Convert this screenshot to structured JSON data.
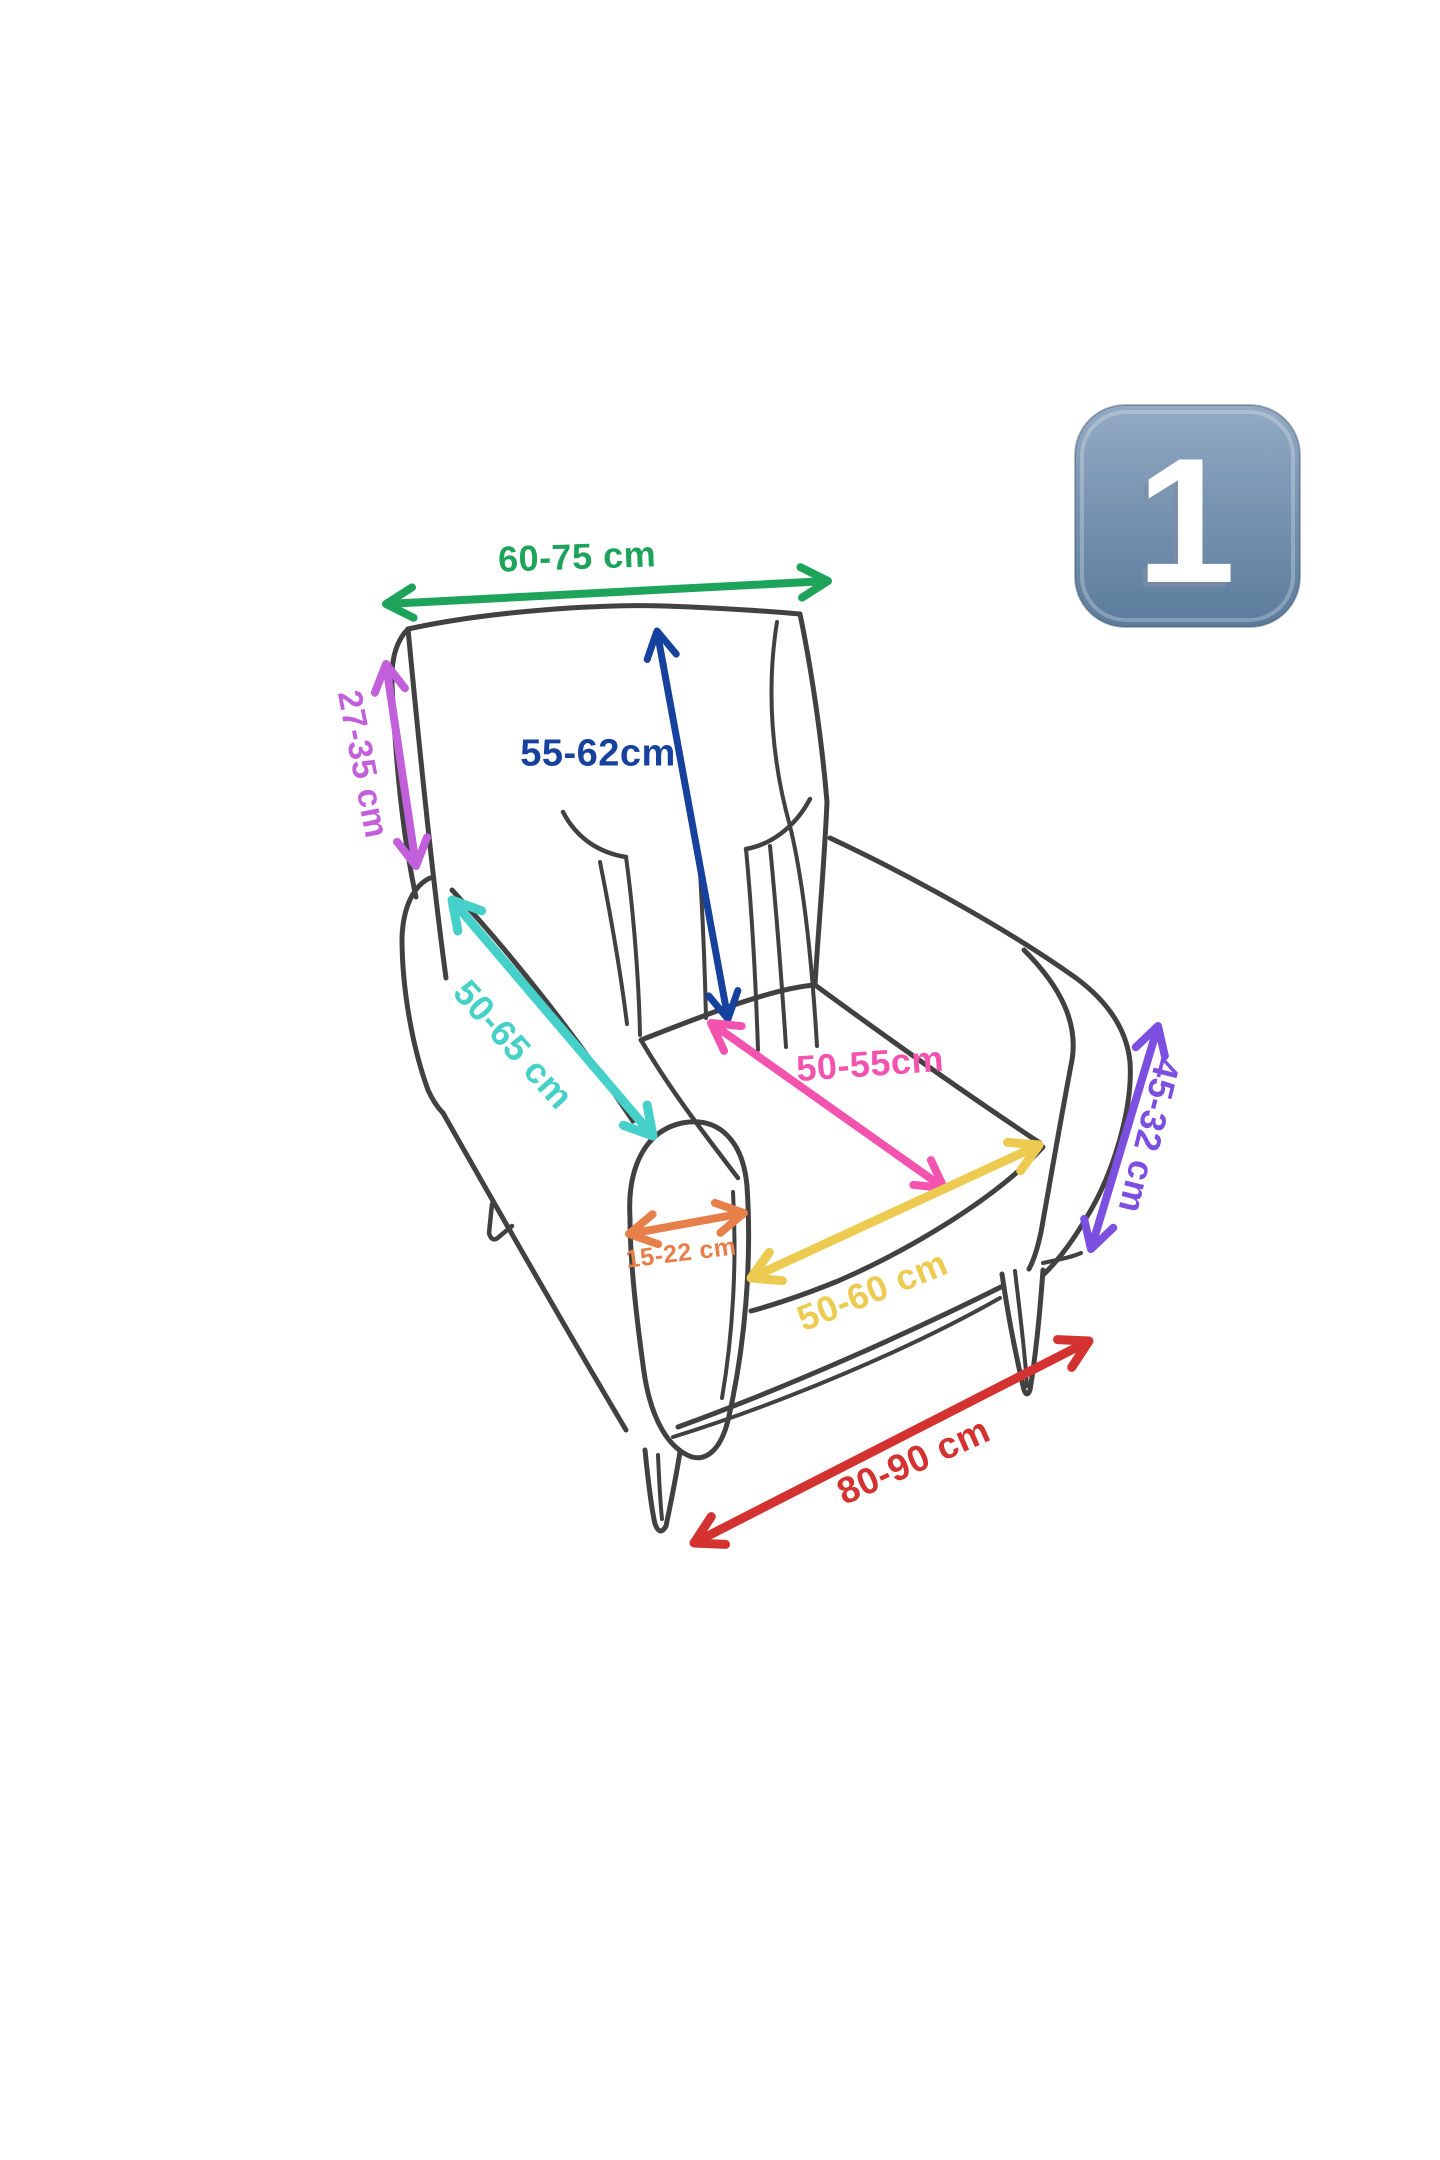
{
  "badge": {
    "label": "1",
    "bg_top": "#93aac3",
    "bg_mid": "#7592b0",
    "bg_bottom": "#5c7c9d",
    "text_color": "#ffffff",
    "shadow_color": "#7d8fa6"
  },
  "sketch": {
    "stroke_color": "#2d2d2d"
  },
  "dimensions": [
    {
      "id": "back-width",
      "label": "60-75 cm",
      "color": "#1ea35b",
      "x1": 386,
      "y1": 604,
      "x2": 828,
      "y2": 581,
      "lx": 577,
      "ly": 556,
      "rot": -2,
      "fs": 36,
      "w": 8
    },
    {
      "id": "back-side-depth",
      "label": "27-35 cm",
      "color": "#c25fda",
      "x1": 386,
      "y1": 664,
      "x2": 416,
      "y2": 866,
      "lx": 364,
      "ly": 764,
      "rot": 79,
      "fs": 34,
      "w": 8
    },
    {
      "id": "back-height",
      "label": "55-62cm",
      "color": "#16429e",
      "x1": 657,
      "y1": 631,
      "x2": 728,
      "y2": 1019,
      "lx": 598,
      "ly": 752,
      "rot": 0,
      "fs": 38,
      "w": 7
    },
    {
      "id": "armrest-length",
      "label": "50-65 cm",
      "color": "#45d0c9",
      "x1": 452,
      "y1": 900,
      "x2": 653,
      "y2": 1136,
      "lx": 514,
      "ly": 1044,
      "rot": 48,
      "fs": 36,
      "w": 9
    },
    {
      "id": "seat-depth",
      "label": "50-55cm",
      "color": "#f153af",
      "x1": 711,
      "y1": 1023,
      "x2": 944,
      "y2": 1188,
      "lx": 870,
      "ly": 1063,
      "rot": -4,
      "fs": 36,
      "w": 8
    },
    {
      "id": "armrest-width",
      "label": "15-22 cm",
      "color": "#e67f49",
      "x1": 629,
      "y1": 1234,
      "x2": 744,
      "y2": 1213,
      "lx": 681,
      "ly": 1252,
      "rot": -7,
      "fs": 25,
      "w": 8
    },
    {
      "id": "seat-width",
      "label": "50-60 cm",
      "color": "#edcb50",
      "x1": 751,
      "y1": 1278,
      "x2": 1039,
      "y2": 1145,
      "lx": 872,
      "ly": 1290,
      "rot": -22,
      "fs": 36,
      "w": 9
    },
    {
      "id": "arm-height",
      "label": "45-32 cm",
      "color": "#7c4fe0",
      "x1": 1158,
      "y1": 1026,
      "x2": 1091,
      "y2": 1249,
      "lx": 1150,
      "ly": 1136,
      "rot": 104,
      "fs": 36,
      "w": 8
    },
    {
      "id": "base-width",
      "label": "80-90 cm",
      "color": "#d43230",
      "x1": 694,
      "y1": 1543,
      "x2": 1089,
      "y2": 1341,
      "lx": 913,
      "ly": 1460,
      "rot": -24,
      "fs": 37,
      "w": 9
    }
  ]
}
